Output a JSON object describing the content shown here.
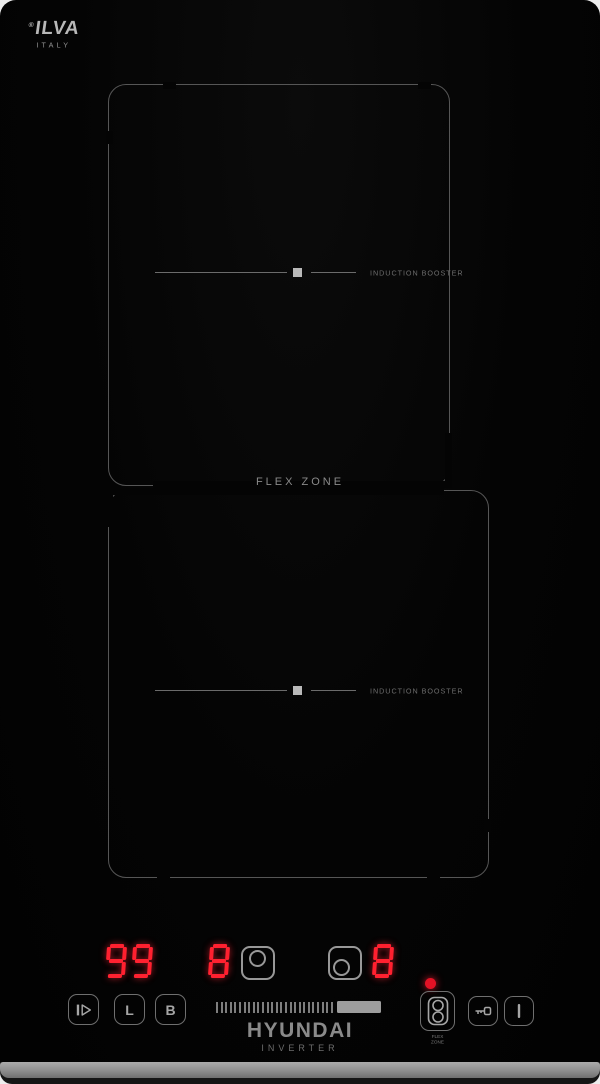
{
  "logo": {
    "reg": "®",
    "name": "ILVA",
    "sub": "ITALY"
  },
  "flex_zone_label": "FLEX ZONE",
  "zones": [
    {
      "booster_label": "INDUCTION BOOSTER"
    },
    {
      "booster_label": "INDUCTION BOOSTER"
    }
  ],
  "displays": {
    "timer_value": "99",
    "rear_zone_level": "8",
    "front_zone_level": "8"
  },
  "controls": {
    "lock_label": "L",
    "booster_label": "B",
    "flex_caption_line1": "FLEX",
    "flex_caption_line2": "ZONE"
  },
  "branding": {
    "name": "HYUNDAI",
    "sub": "INVERTER"
  },
  "slider": {
    "tick_count": 26
  },
  "colors": {
    "led_red": "#ff2130",
    "indicator_red": "#e31225",
    "outline_gray": "#565656",
    "label_gray": "#8a8a8a",
    "surface_black": "#040404",
    "metal_edge": "#9a9a9a"
  }
}
